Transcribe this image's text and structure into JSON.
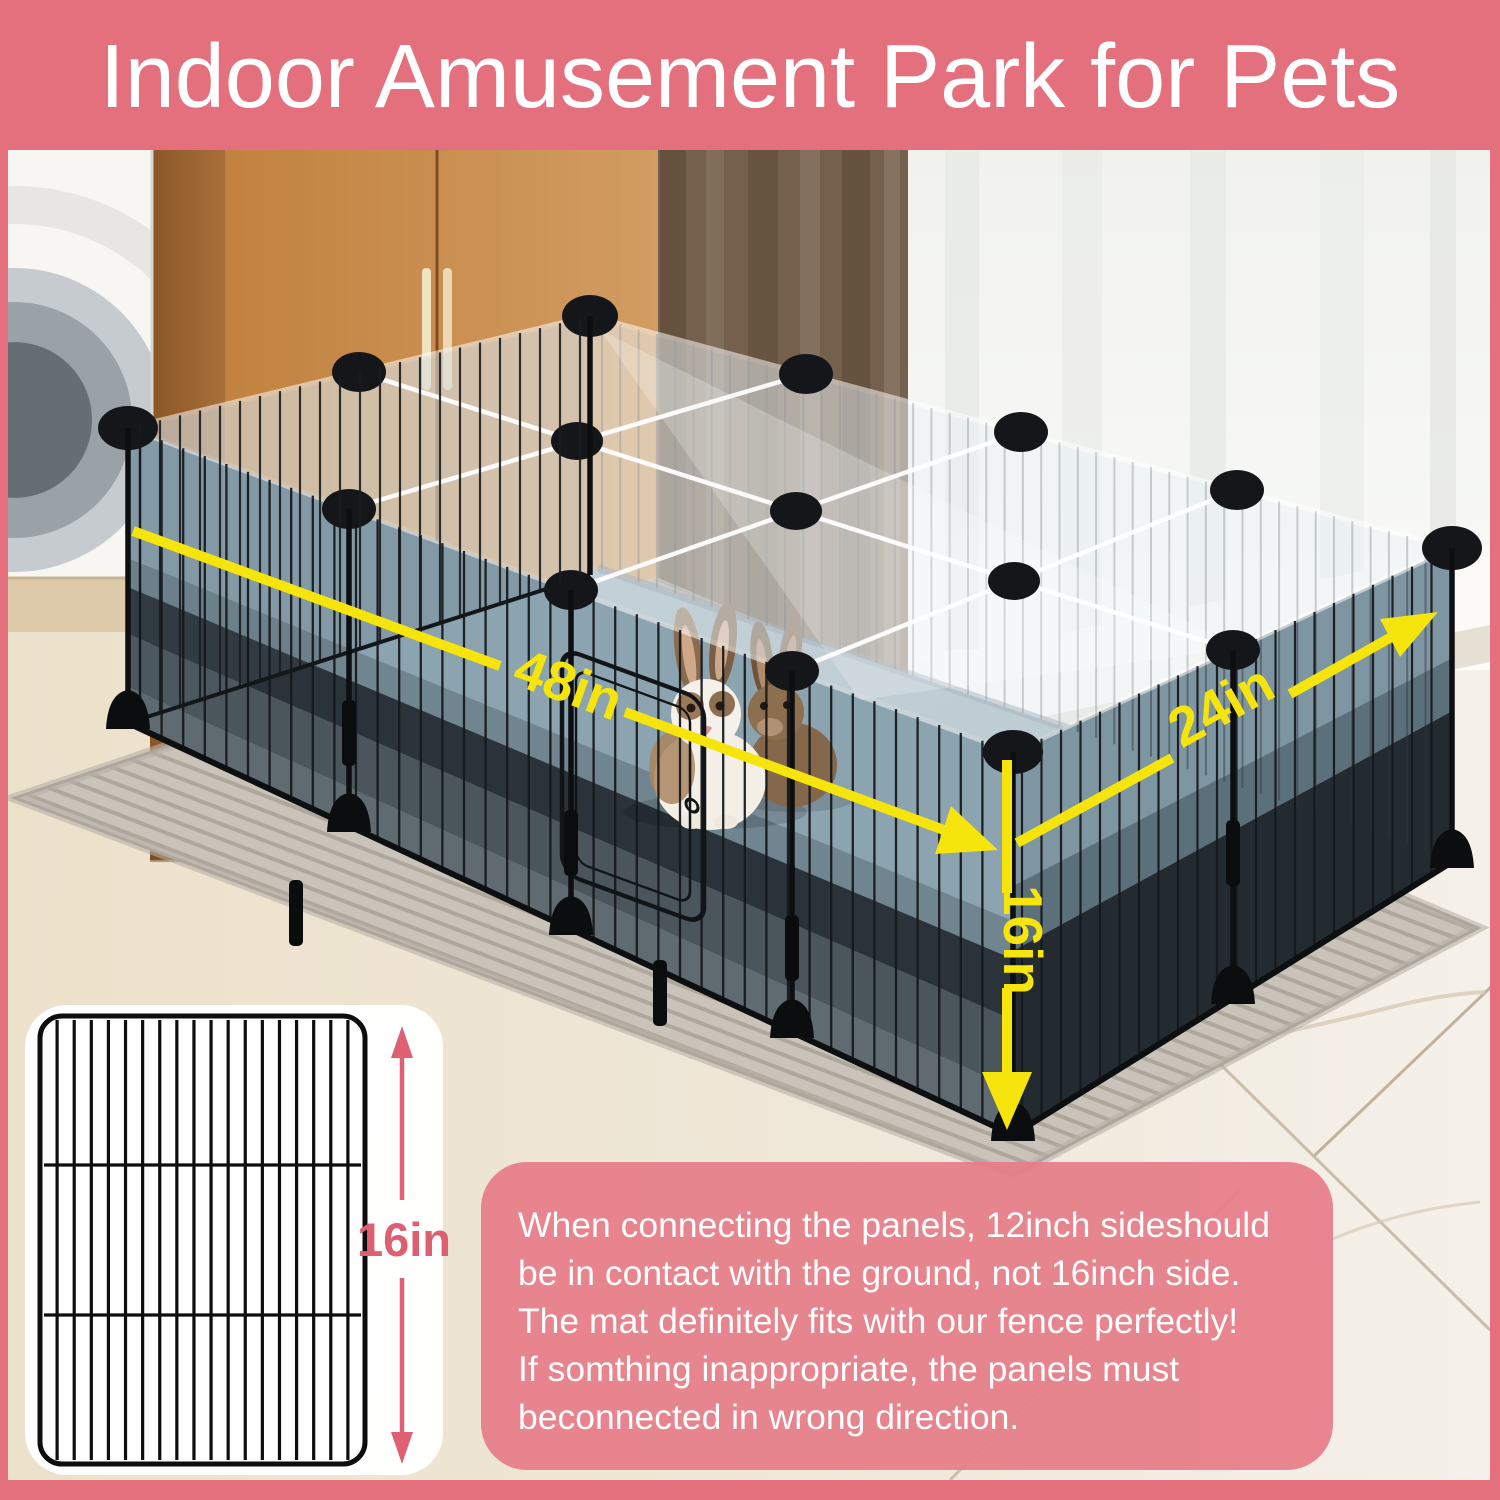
{
  "banner": {
    "title": "Indoor Amusement Park for Pets",
    "bg_color": "#e5707d",
    "text_color": "#ffffff"
  },
  "diagram": {
    "length_label": "48in",
    "width_label": "24in",
    "height_label": "16in",
    "arrow_color": "#f6e50c"
  },
  "panel_card": {
    "height_label": "16in",
    "accent_color": "#dd5f72",
    "card_bg": "#ffffff"
  },
  "note": {
    "bg_color": "#e67d89",
    "text_color": "#fdfdfd",
    "lines": [
      "When connecting the panels, 12inch sideshould",
      "be in contact with the ground, not 16inch side.",
      "The mat definitely fits with our fence perfectly!",
      "If somthing inappropriate, the panels must",
      "beconnected in wrong direction."
    ]
  }
}
